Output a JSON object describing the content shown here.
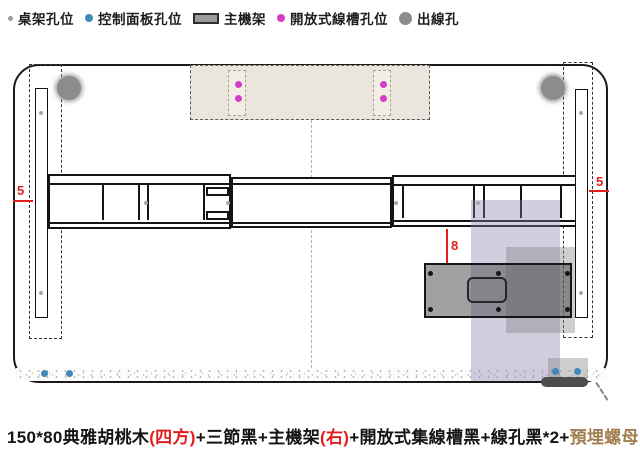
{
  "legend": {
    "items": [
      {
        "label": "桌架孔位",
        "icon": "dot-small",
        "color": "#9a9a9a"
      },
      {
        "label": "控制面板孔位",
        "icon": "dot-medium",
        "color": "#3d89b8"
      },
      {
        "label": "主機架",
        "icon": "rect",
        "color": "#9b9b9b"
      },
      {
        "label": "開放式線槽孔位",
        "icon": "dot-medium",
        "color": "#d43fc6"
      },
      {
        "label": "出線孔",
        "icon": "dot-large",
        "color": "#8c8c8c"
      }
    ]
  },
  "caption": {
    "segments": [
      {
        "text": "150*80典雅胡桃木",
        "color": "#141414"
      },
      {
        "text": "(四方)",
        "color": "#e02020"
      },
      {
        "text": "+三節黑+主機架",
        "color": "#141414"
      },
      {
        "text": "(右)",
        "color": "#e02020"
      },
      {
        "text": "+開放式集線槽黑+線孔黑*2+",
        "color": "#141414"
      },
      {
        "text": "預埋螺母",
        "color": "#a07e50"
      }
    ]
  },
  "dimensions": {
    "left_edge_offset": "5",
    "right_edge_offset": "5",
    "bracket_offset": "8"
  },
  "diagram": {
    "colors": {
      "red": "#e02020",
      "purple_overlay": "rgba(137,123,170,0.38)",
      "gray_overlay": "rgba(125,125,125,0.38)",
      "tray_background": "#ebe6dd",
      "bracket_fill": "rgba(75,75,75,0.52)"
    },
    "holes": {
      "frame": {
        "color": "#a8a8a8",
        "size": 4,
        "points": [
          [
            41,
            113
          ],
          [
            41,
            293
          ],
          [
            581,
            113
          ],
          [
            581,
            293
          ],
          [
            146,
            203
          ],
          [
            228,
            203
          ],
          [
            396,
            203
          ],
          [
            478,
            203
          ]
        ]
      },
      "control_panel": {
        "color": "#3d89b8",
        "size": 7,
        "points": [
          [
            44,
            373
          ],
          [
            69,
            373
          ],
          [
            555,
            371
          ],
          [
            577,
            371
          ]
        ]
      },
      "cable_tray": {
        "color": "#d43fc6",
        "size": 7,
        "points": [
          [
            238,
            84
          ],
          [
            238,
            98
          ],
          [
            383,
            84
          ],
          [
            383,
            98
          ]
        ]
      },
      "outlet": {
        "color": "#8c8c8c",
        "size": 24,
        "points": [
          [
            69,
            88
          ],
          [
            553,
            88
          ]
        ]
      },
      "bracket_screws": {
        "color": "#151515",
        "size": 5,
        "points": [
          [
            430,
            273
          ],
          [
            430,
            309
          ],
          [
            498,
            273
          ],
          [
            498,
            309
          ],
          [
            567,
            273
          ],
          [
            567,
            309
          ]
        ]
      }
    }
  }
}
